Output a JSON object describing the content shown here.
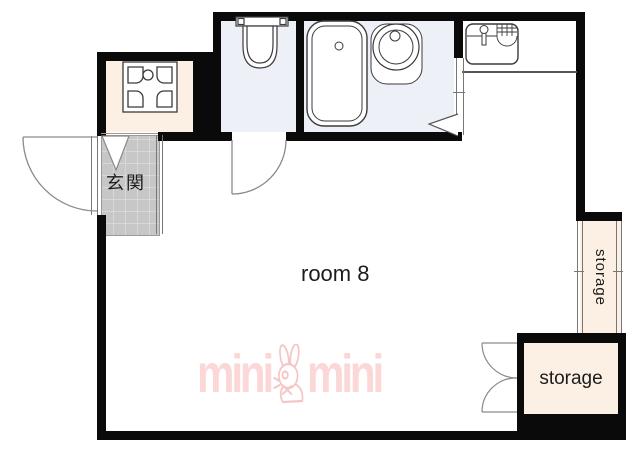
{
  "plan": {
    "labels": {
      "genkan": "玄関",
      "main_room": "room 8",
      "storage_vertical": "storage",
      "storage_bottom": "storage"
    },
    "watermark": {
      "word_left": "mini",
      "word_right": "mini",
      "mascot": "rabbit"
    },
    "colors": {
      "wall": "#0a0a0a",
      "room_beige": "#fbf0e3",
      "wet_floor": "#edf1f7",
      "tile_gray": "#c7c7c7",
      "tile_line": "#d8d8d8",
      "brand_pink": "#fbd7d7",
      "brand_pink_stroke": "#f6c6c6",
      "line_gray": "#555555",
      "text": "#1c1c1c"
    },
    "fixtures": [
      "washing-machine-pan",
      "toilet",
      "bathtub",
      "wash-basin",
      "kitchen-sink"
    ]
  }
}
